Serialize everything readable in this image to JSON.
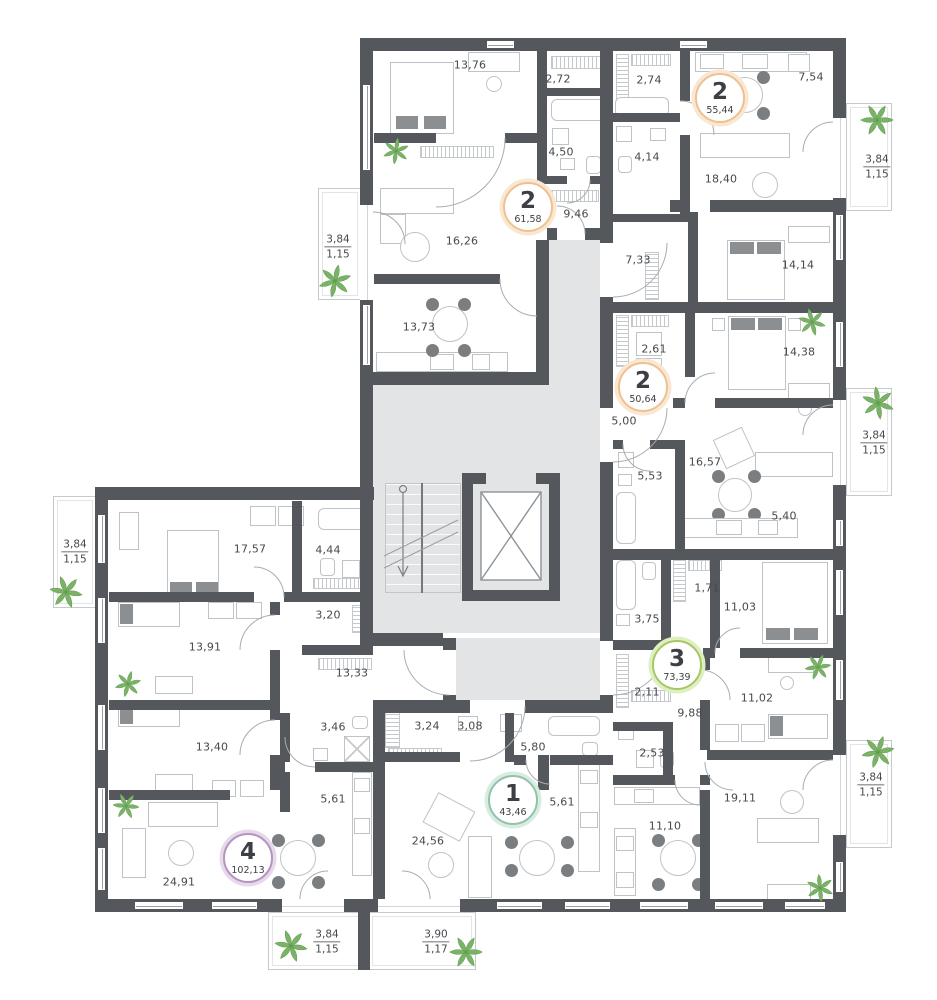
{
  "plan_type": "residential-floor-plan",
  "colors": {
    "wall": "#54585c",
    "floor_common": "#e3e4e5",
    "plant": "#7cb268",
    "badge_2rooms_ring": "#eec193",
    "badge_3rooms_ring": "#a6c765",
    "badge_1room_ring": "#92c2a8",
    "badge_4rooms_ring": "#b394bd"
  },
  "apartments": [
    {
      "id": "A",
      "rooms_count": "2",
      "total_area": "61,58",
      "rooms": [
        "13,76",
        "2,72",
        "4,50",
        "9,46",
        "16,26",
        "13,73"
      ]
    },
    {
      "id": "B",
      "rooms_count": "2",
      "total_area": "55,44",
      "rooms": [
        "2,74",
        "7,54",
        "4,14",
        "18,40",
        "7,33",
        "14,14"
      ]
    },
    {
      "id": "C",
      "rooms_count": "2",
      "total_area": "50,64",
      "rooms": [
        "2,61",
        "14,38",
        "5,00",
        "5,53",
        "16,57",
        "5,40"
      ]
    },
    {
      "id": "D",
      "rooms_count": "3",
      "total_area": "73,39",
      "rooms": [
        "1,71",
        "11,03",
        "3,75",
        "2,11",
        "9,88",
        "11,02",
        "2,53",
        "11,10",
        "19,11"
      ]
    },
    {
      "id": "E",
      "rooms_count": "1",
      "total_area": "43,46",
      "rooms": [
        "3,24",
        "3,08",
        "5,80",
        "5,61",
        "24,56"
      ]
    },
    {
      "id": "F",
      "rooms_count": "4",
      "total_area": "102,13",
      "rooms": [
        "17,57",
        "4,44",
        "3,20",
        "13,91",
        "13,33",
        "3,46",
        "13,40",
        "5,61",
        "24,91"
      ]
    }
  ],
  "balconies": [
    {
      "area": "3,84",
      "depth": "1,15"
    },
    {
      "area": "3,84",
      "depth": "1,15"
    },
    {
      "area": "3,84",
      "depth": "1,15"
    },
    {
      "area": "3,84",
      "depth": "1,15"
    },
    {
      "area": "3,84",
      "depth": "1,15"
    },
    {
      "area": "3,84",
      "depth": "1,15"
    },
    {
      "area": "3,90",
      "depth": "1,17"
    }
  ]
}
